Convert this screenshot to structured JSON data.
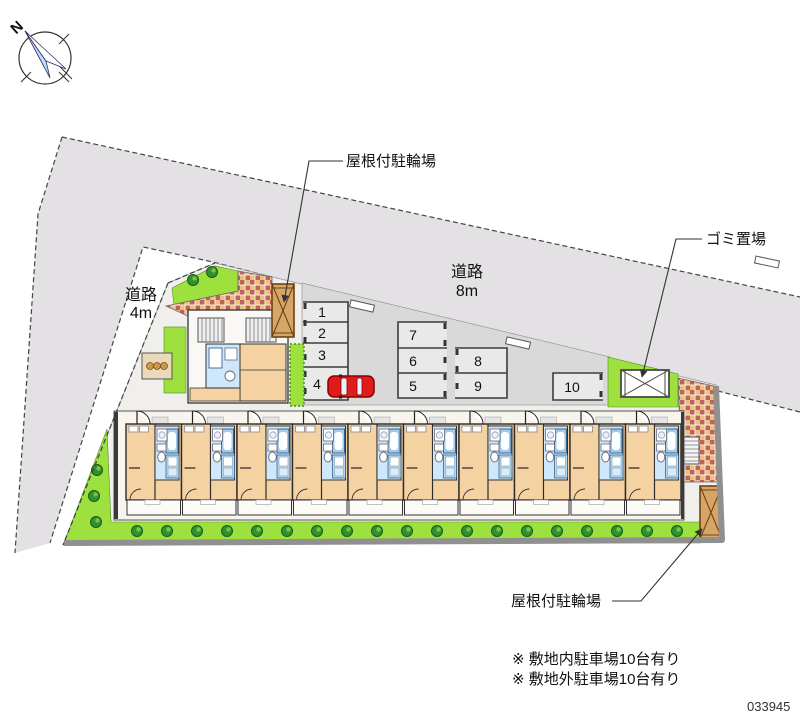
{
  "compass": {
    "north_label": "N"
  },
  "roads": {
    "top": {
      "name": "道路",
      "width_label": "8m"
    },
    "left": {
      "name": "道路",
      "width_label": "4m"
    }
  },
  "annotations": {
    "bicycle_parking_top": "屋根付駐輪場",
    "garbage_area": "ゴミ置場",
    "bicycle_parking_bottom": "屋根付駐輪場"
  },
  "parking": {
    "spaces": [
      "1",
      "2",
      "3",
      "4",
      "5",
      "6",
      "7",
      "8",
      "9",
      "10"
    ]
  },
  "notes": [
    "※ 敷地内駐車場10台有り",
    "※ 敷地外駐車場10台有り"
  ],
  "plan_number": "033945",
  "colors": {
    "road": "#e3e1e3",
    "site": "#f1efeb",
    "parking_lot": "#d9d9d9",
    "stall": "#e9e9e9",
    "lawn": "#9ee03e",
    "bush": "#2f9130",
    "room_tan": "#f5d2a2",
    "wet_blue": "#cfe7fa",
    "brick_tan": "#e7c37e",
    "brick_red": "#bf6161",
    "bike_shed": "#d7a567",
    "car_red": "#e01b1b",
    "wall_gray": "#909090",
    "compass_needle": "#badff4"
  }
}
